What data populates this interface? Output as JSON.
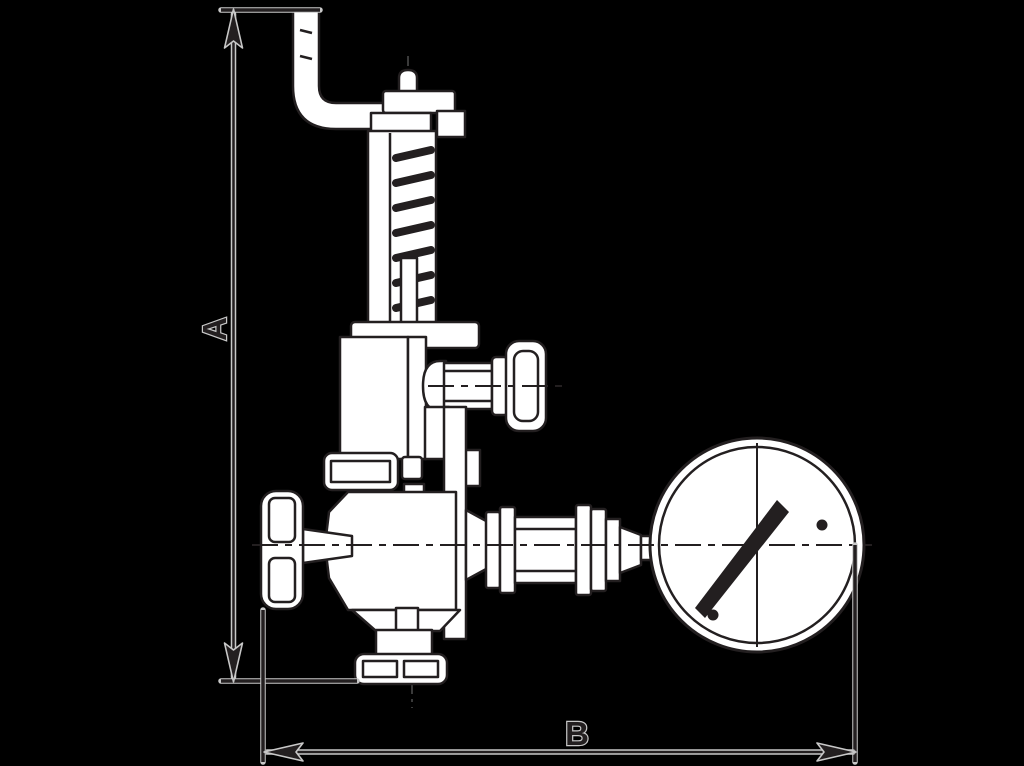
{
  "figure": {
    "description": "Dimensioned outline drawing of a spring safety valve assembly with bent lever pipe, side test port, handwheel, bottom outlet flange and connected pressure gauge",
    "dimensions": {
      "a": {
        "label": "A",
        "orientation": "vertical"
      },
      "b": {
        "label": "B",
        "orientation": "horizontal"
      }
    }
  },
  "colors": {
    "bg": "#000000",
    "line": "#231f20",
    "white": "#ffffff",
    "halo": "#c8c8c8"
  }
}
